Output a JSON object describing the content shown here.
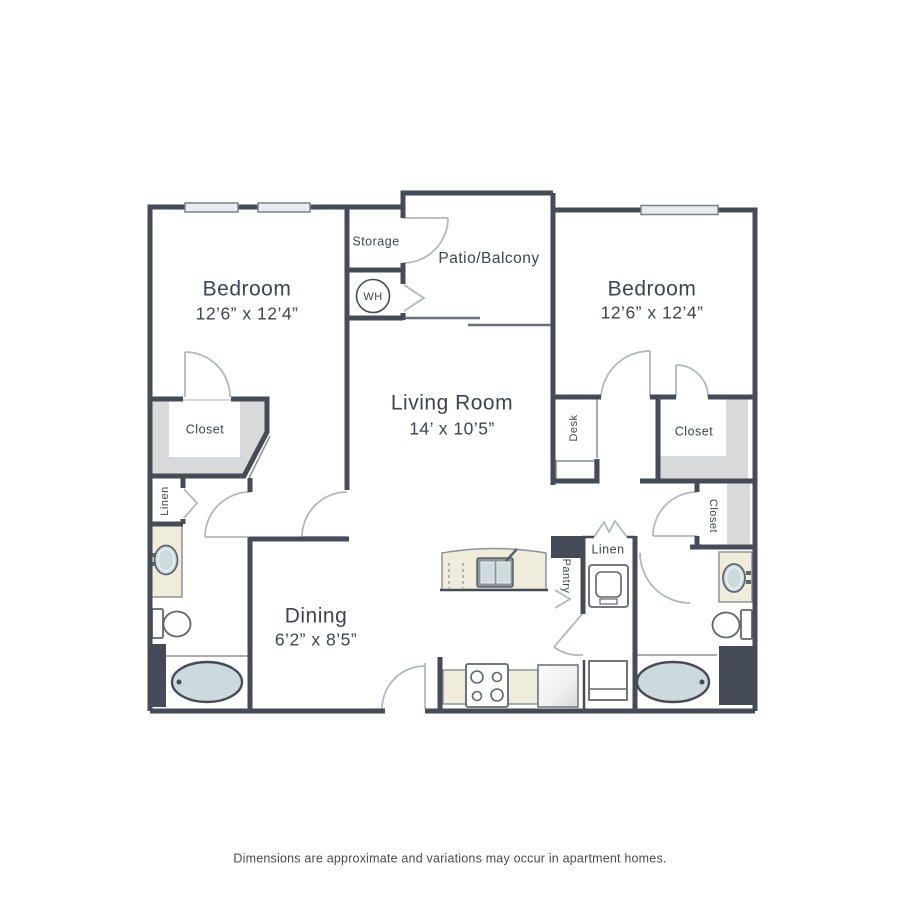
{
  "plan": {
    "bedroom_left": {
      "name": "Bedroom",
      "dims": "12’6” x 12’4”"
    },
    "bedroom_right": {
      "name": "Bedroom",
      "dims": "12’6” x 12’4”"
    },
    "living_room": {
      "name": "Living Room",
      "dims": "14’ x 10’5”"
    },
    "dining": {
      "name": "Dining",
      "dims": "6’2” x 8’5”"
    },
    "patio": {
      "name": "Patio/Balcony"
    },
    "storage": {
      "name": "Storage"
    },
    "water_heater": {
      "abbr": "WH"
    },
    "closet_left": {
      "name": "Closet"
    },
    "closet_right": {
      "name": "Closet"
    },
    "closet_right_lower": {
      "name": "Closet"
    },
    "linen_left": {
      "name": "Linen"
    },
    "linen_center": {
      "name": "Linen"
    },
    "pantry": {
      "name": "Pantry"
    },
    "desk": {
      "name": "Desk"
    }
  },
  "footer": {
    "disclaimer": "Dimensions are approximate and variations may occur in apartment homes."
  },
  "colors": {
    "wall": "#454b57",
    "closet_fill": "#d8d9db",
    "counter_fill": "#efecdb",
    "fixture_fill": "#ccdade",
    "window_fill": "#e9ebee",
    "text": "#3e4450"
  }
}
